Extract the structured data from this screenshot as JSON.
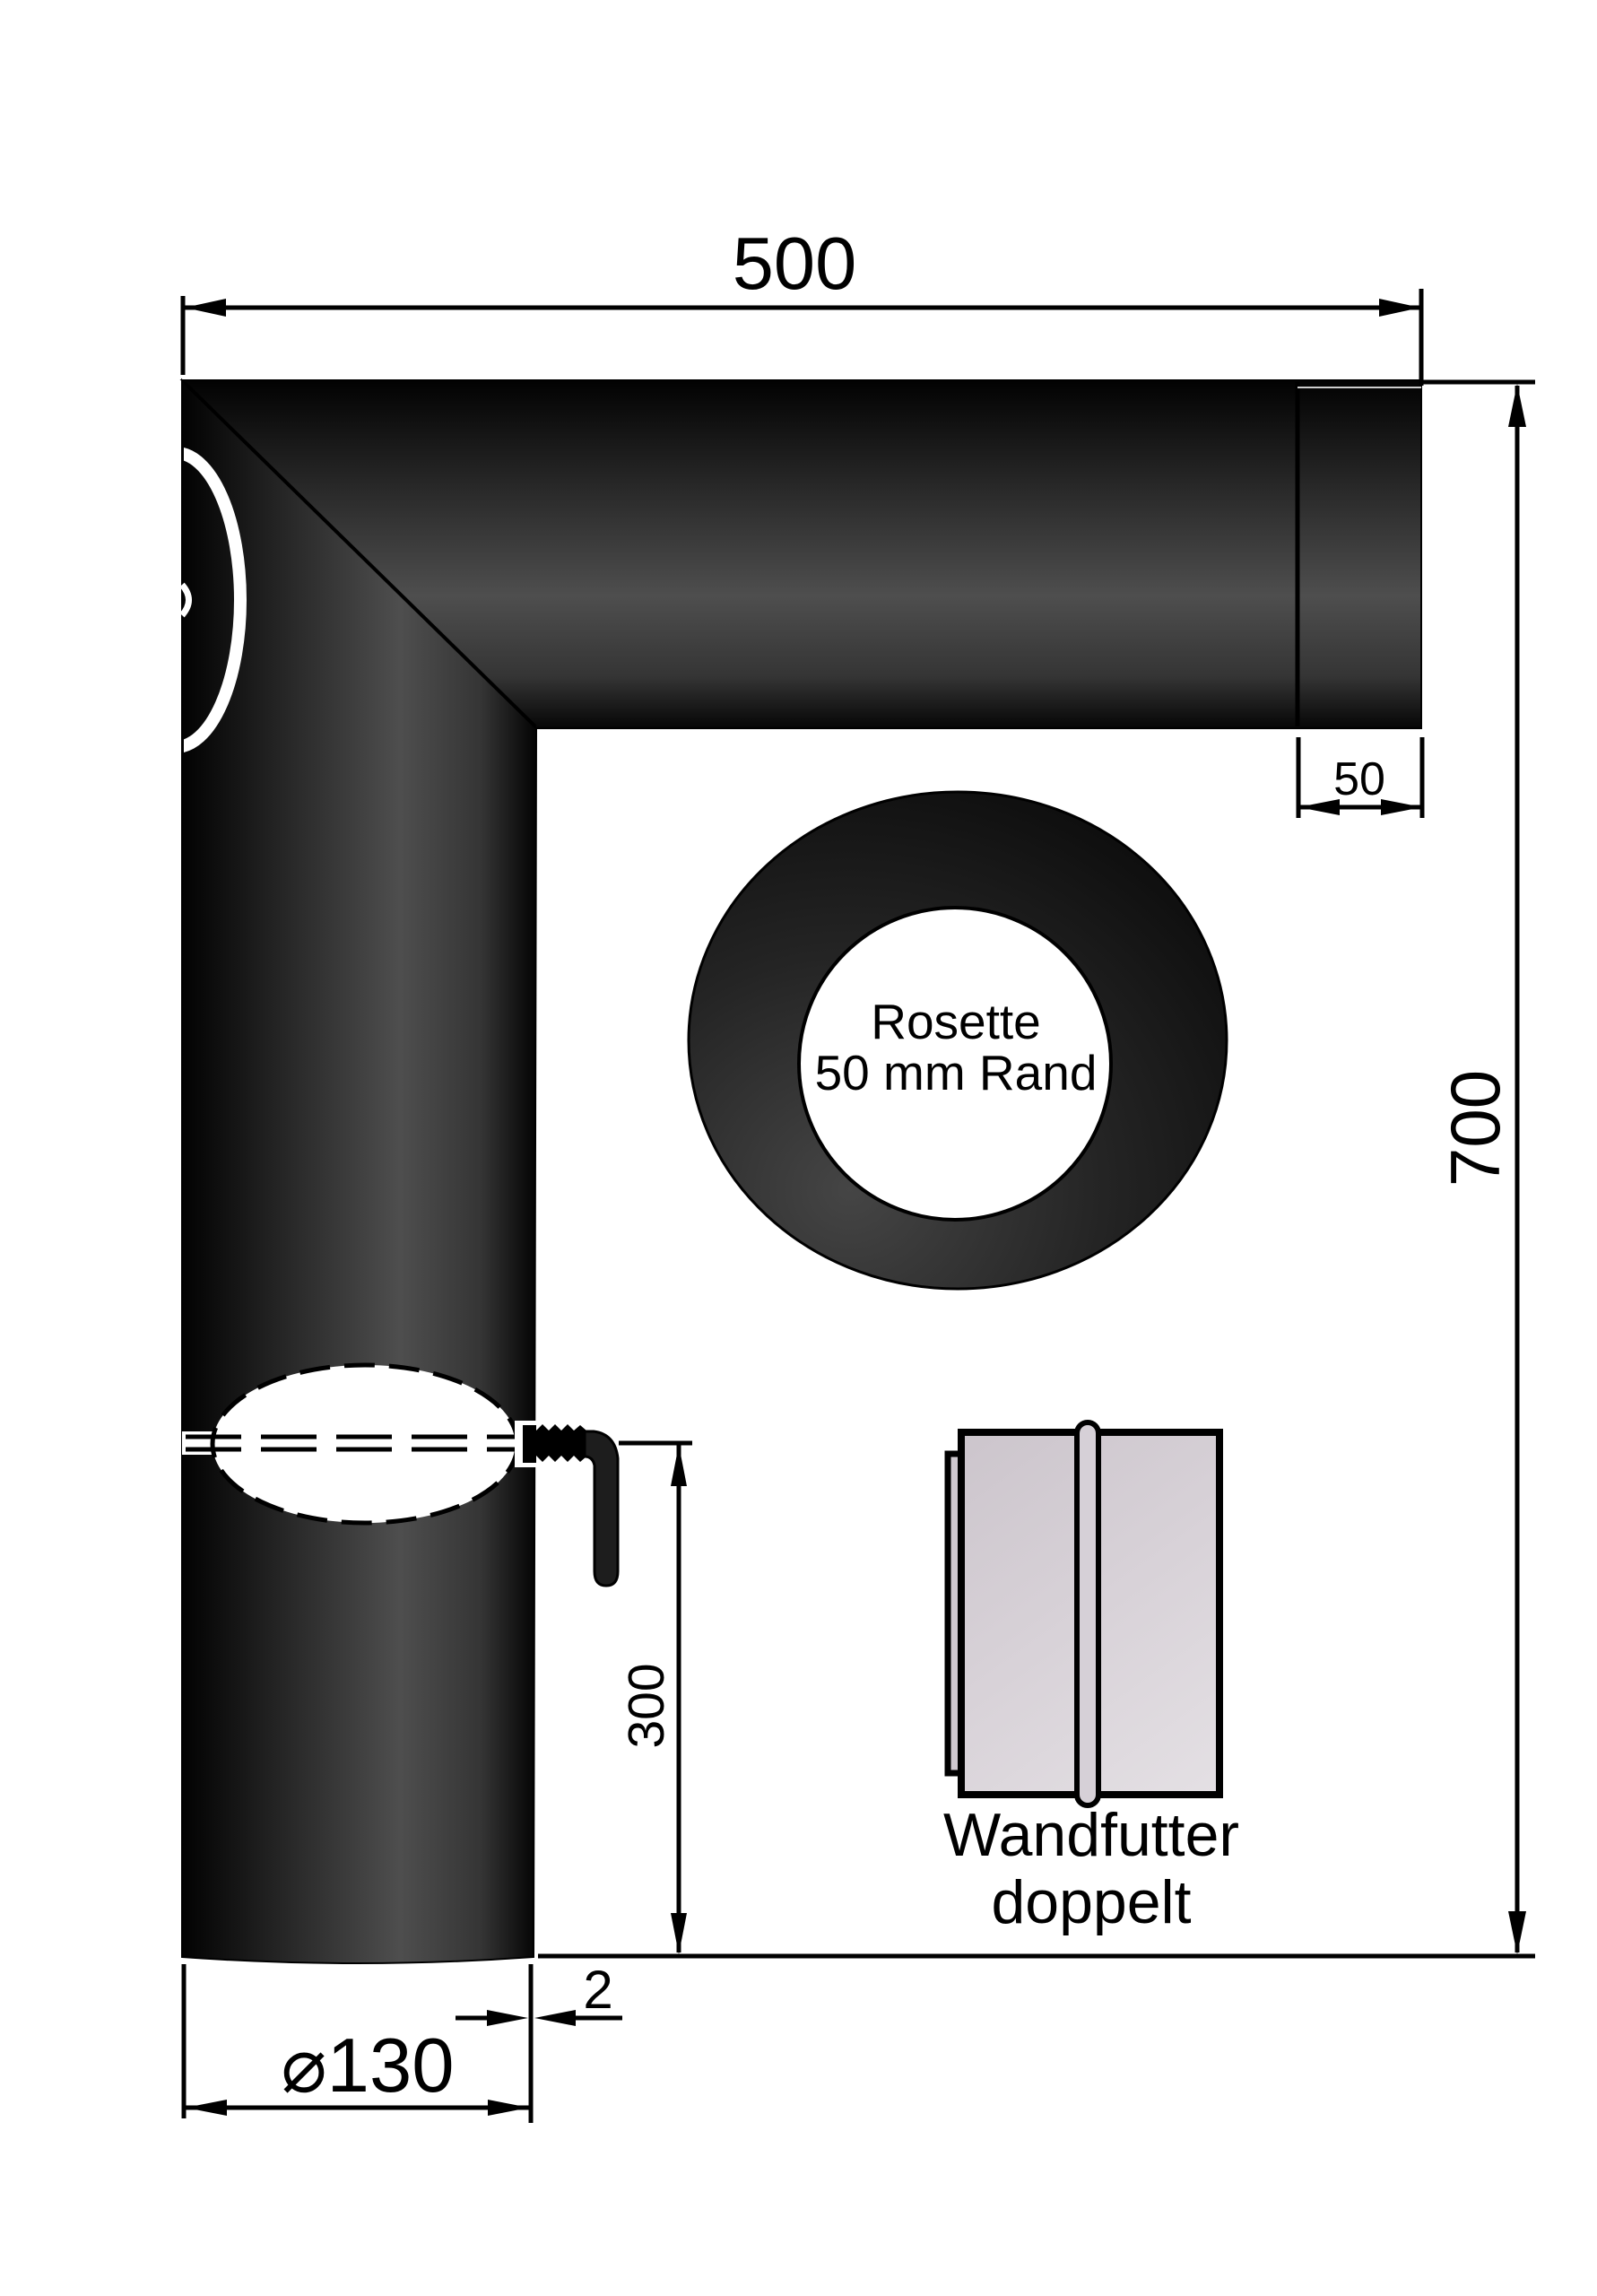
{
  "dimensions": {
    "top_length": "500",
    "collar_depth": "50",
    "total_height": "700",
    "handle_to_end": "300",
    "wall_thickness": "2",
    "pipe_diameter": "⌀130"
  },
  "labels": {
    "rosette_line1": "Rosette",
    "rosette_line2": "50 mm Rand",
    "wandfutter_line1": "Wandfutter",
    "wandfutter_line2": "doppelt"
  },
  "colors": {
    "background": "#ffffff",
    "pipe_dark": "#000000",
    "pipe_mid": "#4e4e4e",
    "metal_light": "#d6d0d7",
    "line": "#000000"
  }
}
